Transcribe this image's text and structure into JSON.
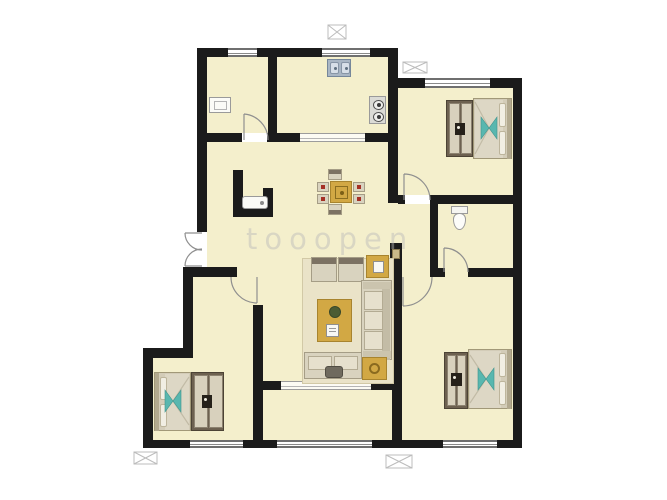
{
  "watermark": "tooopen",
  "palette": {
    "wall": "#1b1b1b",
    "floor": "#f4efcc",
    "rug": "#eae3c8",
    "gold": "#d2a844",
    "goldDark": "#a8842e",
    "teal": "#58b7af",
    "tealDark": "#3d938c",
    "steel": "#a9b6c4",
    "fabric": "#d9d3bf",
    "fabricLight": "#e6e0cd",
    "frame": "#6d6150",
    "panel": "#d8d1bd",
    "bedBase": "#d3ccb8",
    "duvet": "#ddd7c5",
    "pillow": "#f1eee3",
    "arcLine": "#8f8f8f",
    "markerLine": "#bcbcbc",
    "watermark": "#b9b9b9"
  },
  "rooms": [
    {
      "name": "utility-room",
      "fixtures": [
        "washbasin"
      ],
      "doors": [
        "swing-door"
      ],
      "windows": 1
    },
    {
      "name": "kitchen",
      "fixtures": [
        "double-sink",
        "two-burner-stove"
      ],
      "doors": [
        "wide-opening"
      ],
      "windows": 1
    },
    {
      "name": "dining-hall",
      "fixtures": [
        "dining-table",
        "six-dining-chairs",
        "laundry-tub"
      ],
      "doors": [
        "double-entry-door"
      ],
      "windows": 0
    },
    {
      "name": "bedroom-top-right",
      "fixtures": [
        "double-bed",
        "wardrobe"
      ],
      "doors": [
        "swing-door"
      ],
      "windows": 1
    },
    {
      "name": "bathroom",
      "fixtures": [
        "toilet"
      ],
      "doors": [
        "swing-door"
      ],
      "windows": 0
    },
    {
      "name": "living-room",
      "fixtures": [
        "rug",
        "two-armchairs",
        "corner-sofa",
        "coffee-table",
        "bench-seat",
        "two-side-tables"
      ],
      "doors": [
        "wide-opening-to-balcony"
      ],
      "windows": 0
    },
    {
      "name": "balcony-strip",
      "fixtures": [],
      "doors": [],
      "windows": 1
    },
    {
      "name": "bedroom-bottom-left",
      "fixtures": [
        "double-bed",
        "wardrobe"
      ],
      "doors": [
        "swing-door"
      ],
      "windows": 1
    },
    {
      "name": "bedroom-bottom-right",
      "fixtures": [
        "double-bed",
        "wardrobe"
      ],
      "doors": [
        "swing-door"
      ],
      "windows": 1
    }
  ],
  "exterior_symbols": {
    "ac_platform_markers": 4
  }
}
